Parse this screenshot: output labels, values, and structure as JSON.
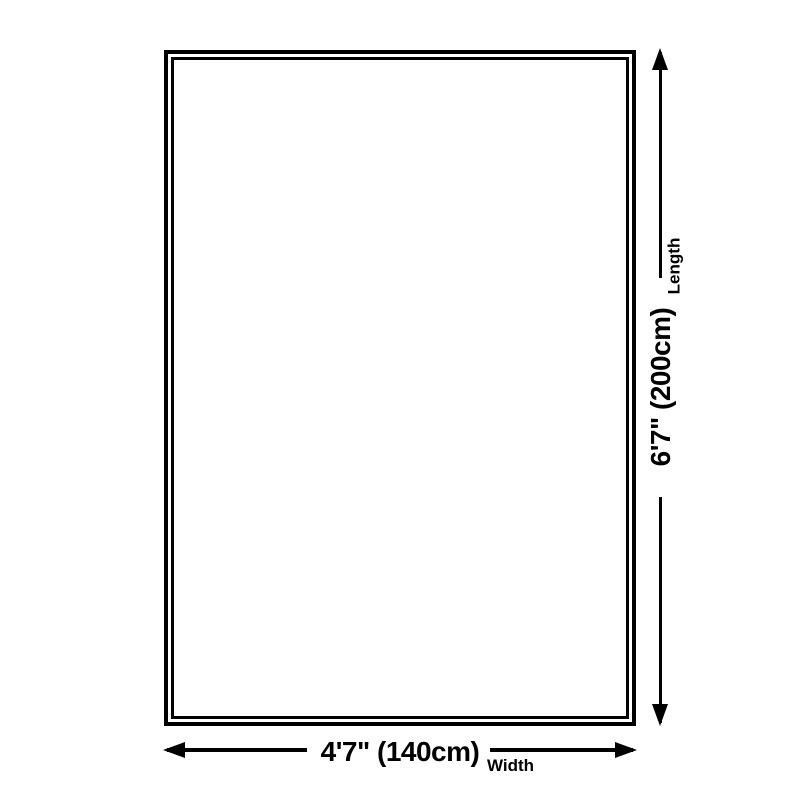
{
  "diagram": {
    "background_color": "#ffffff",
    "line_color": "#000000",
    "width_dimension": {
      "value": "4'7\" (140cm)",
      "label": "Width"
    },
    "length_dimension": {
      "value": "6'7\" (200cm)",
      "label": "Length"
    }
  }
}
